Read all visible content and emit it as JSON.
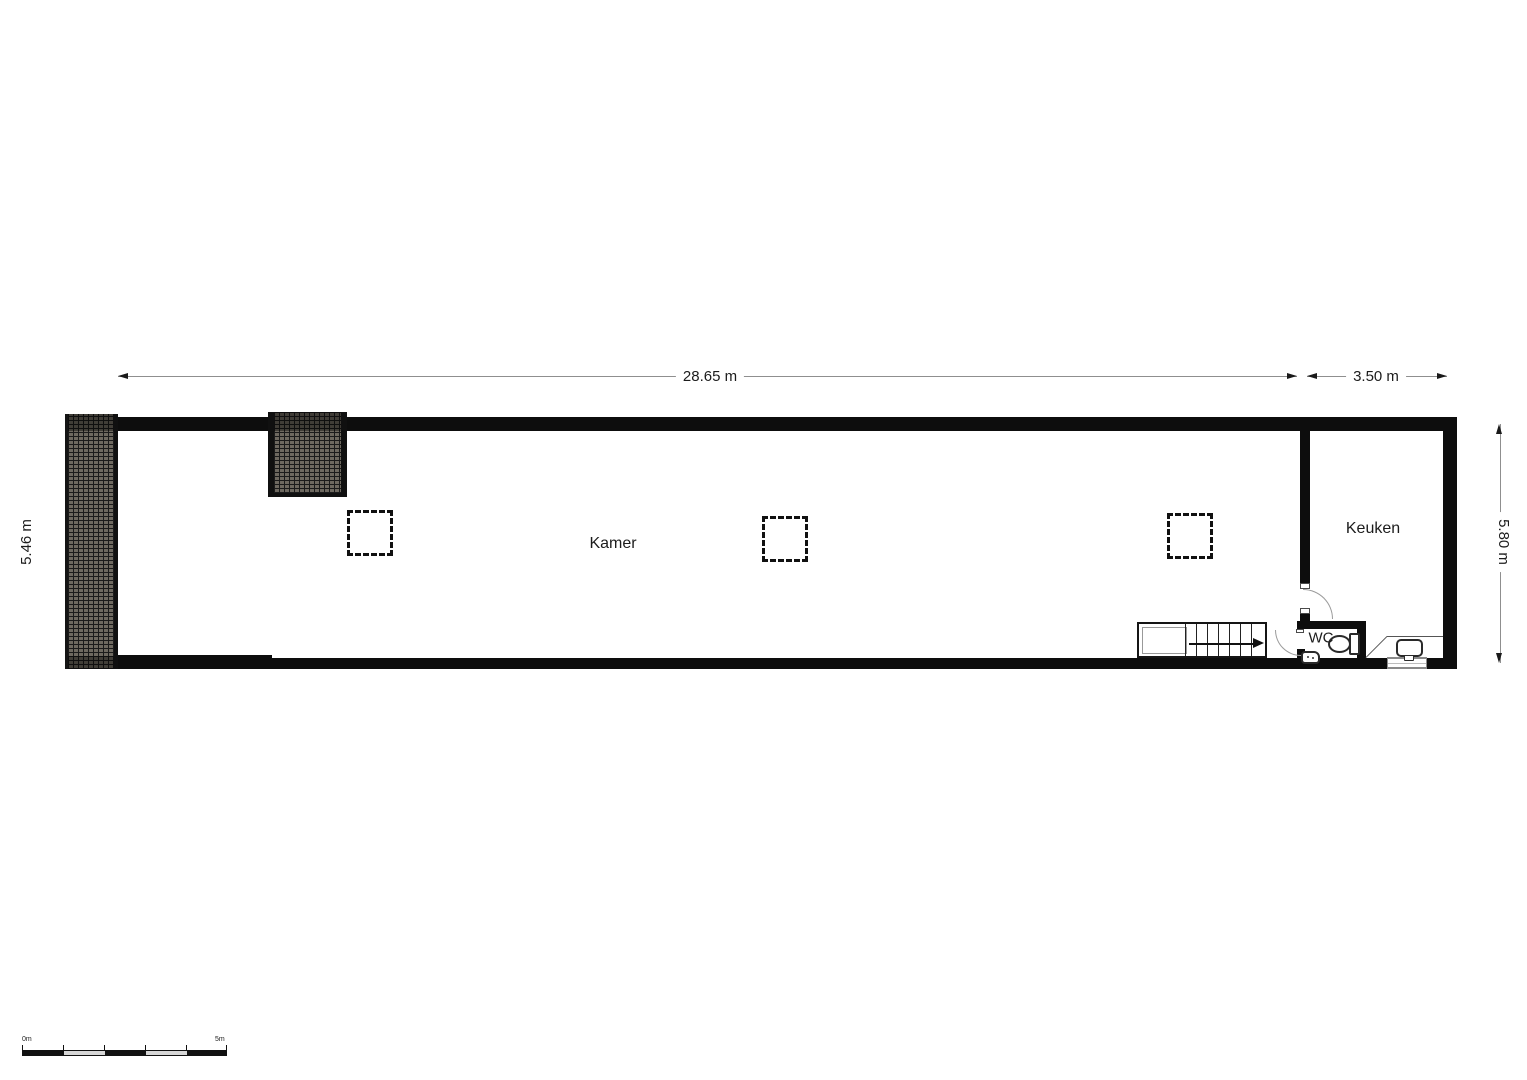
{
  "dimensions": {
    "top_width": "28.65 m",
    "kitchen_width": "3.50 m",
    "left_height": "5.46 m",
    "right_height": "5.80 m"
  },
  "rooms": {
    "living": "Kamer",
    "kitchen": "Keuken",
    "toilet": "WC"
  },
  "scale_bar": {
    "zero_label": "0m",
    "max_label": "5m"
  },
  "colors": {
    "wall": "#0d0d0d",
    "hatch-fill": "#6e6960",
    "hatch-line": "#1b1b1b",
    "dim-line": "#8f8f8f",
    "text": "#1c1c1c",
    "arc": "#9b9b9b",
    "fixture": "#2a2a2a",
    "thin-line": "#555555",
    "scale-light": "#d6d6d6",
    "window-line": "#8a8a8a"
  }
}
